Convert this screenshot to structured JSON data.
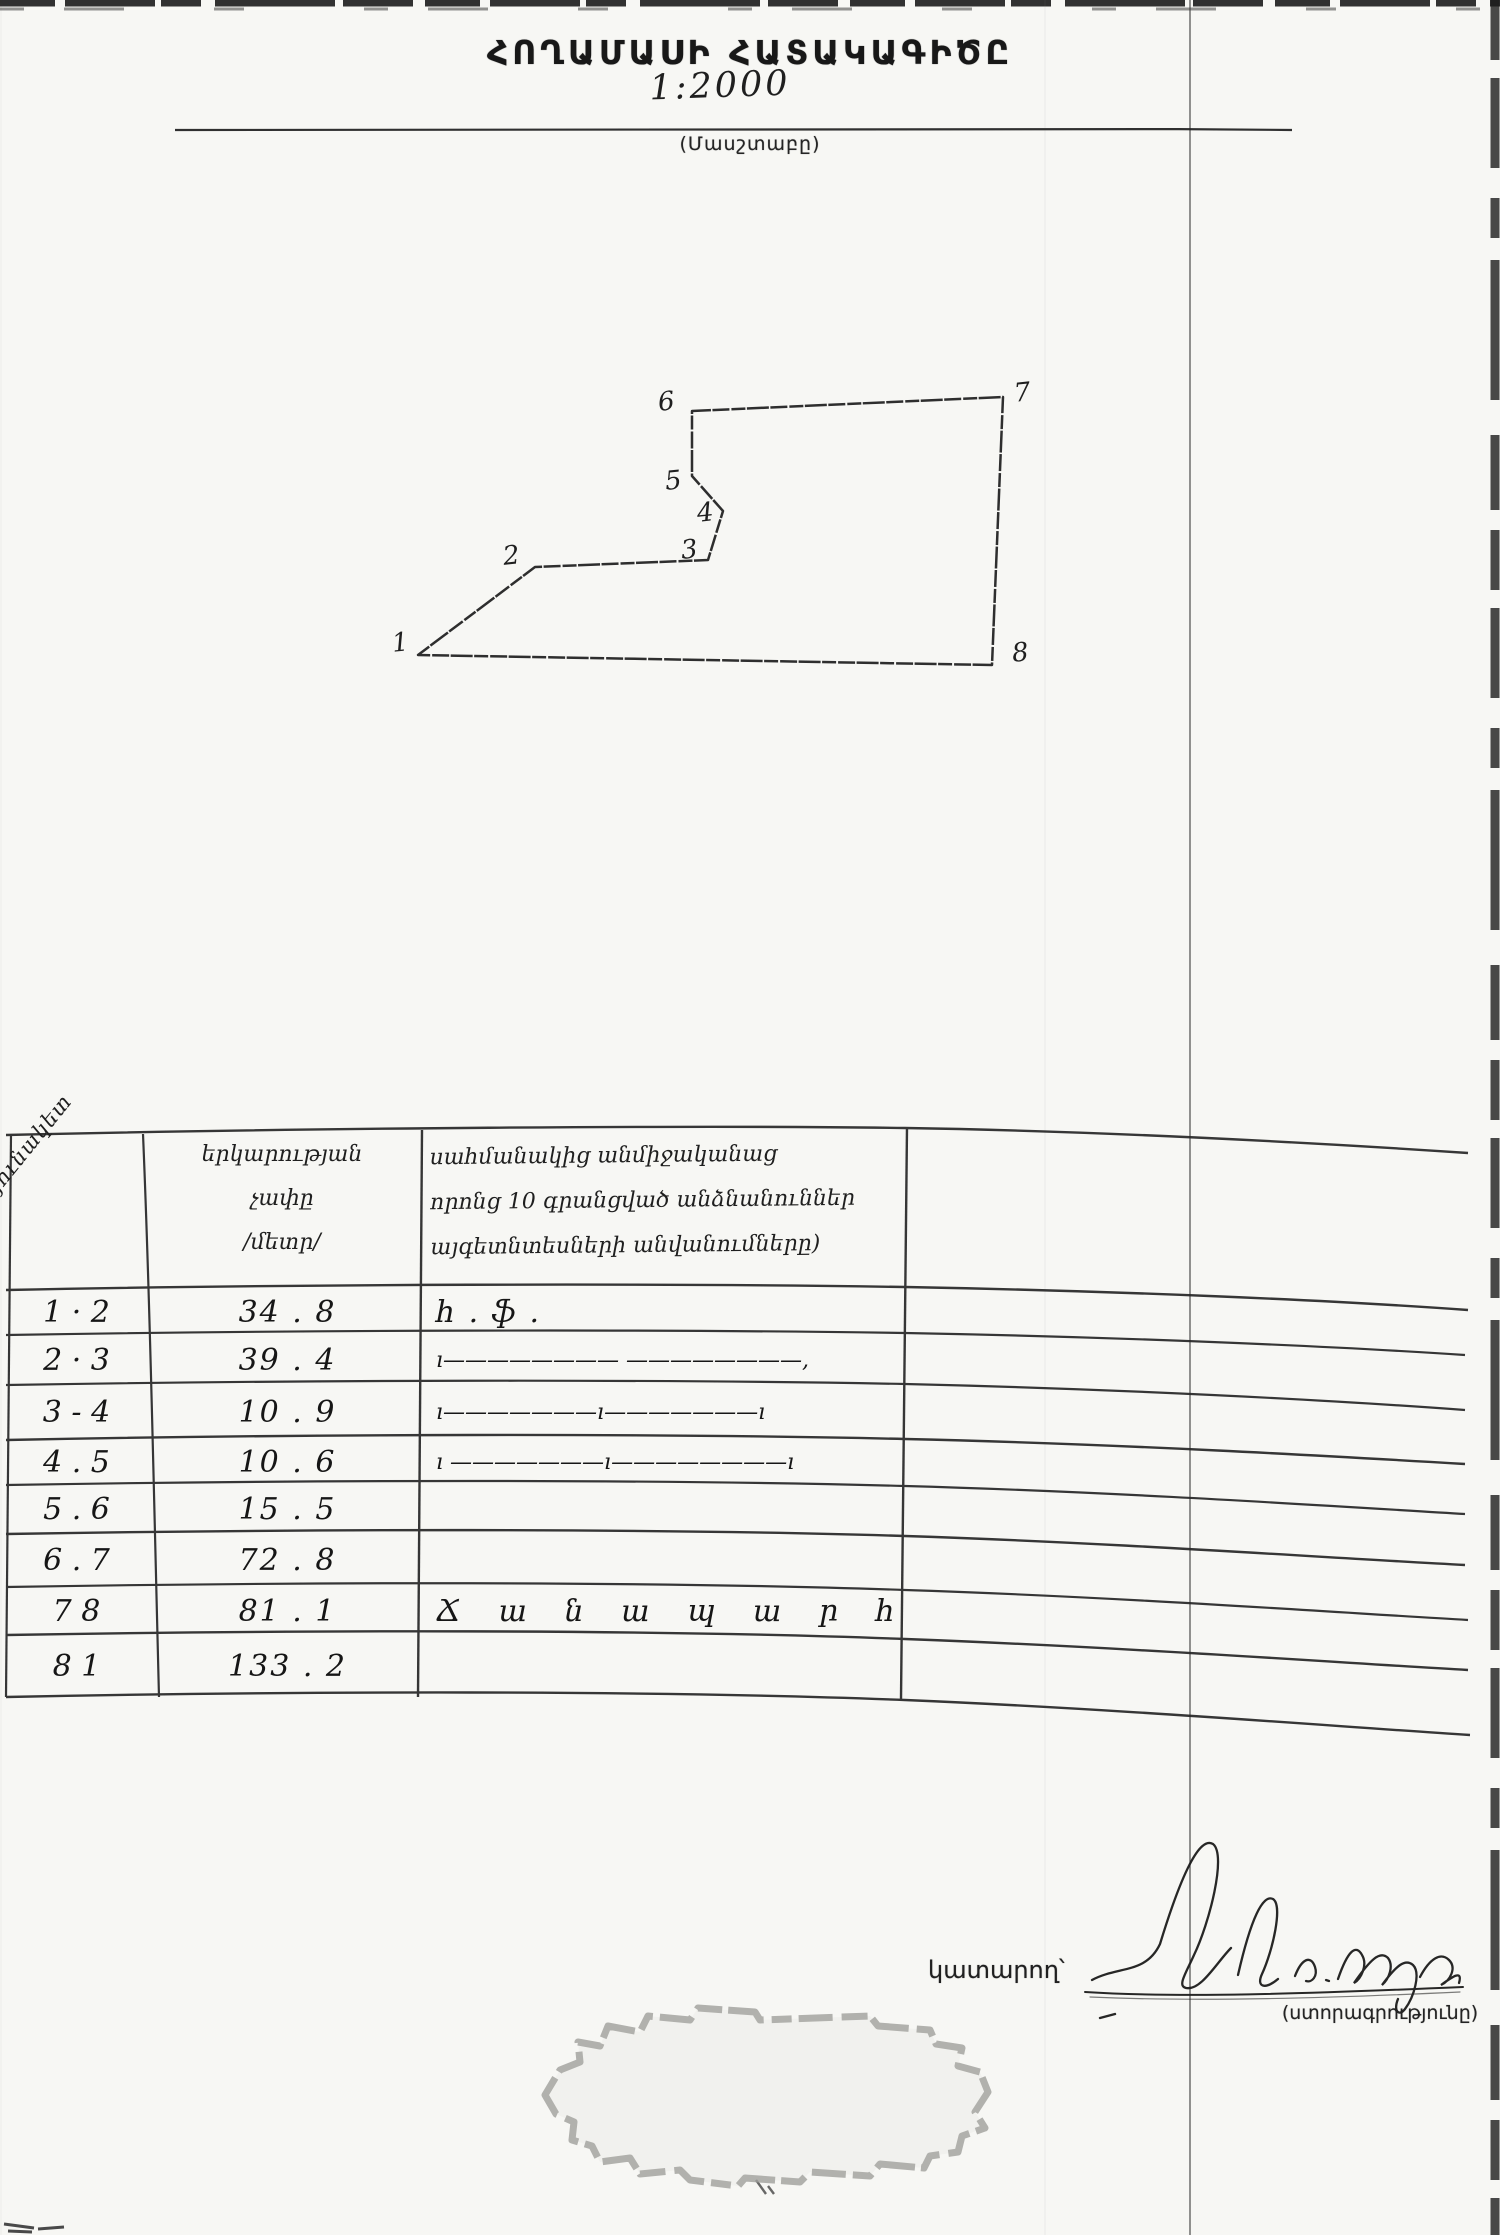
{
  "document": {
    "title": "ՀՈՂԱՄԱՍԻ ՀԱՏԱԿԱԳԻԾԸ",
    "scale": {
      "value": "1:2000",
      "caption": "(Մասշտաբը)"
    }
  },
  "plan": {
    "kind": "hand-drawn land plot boundary sketch with 8 numbered vertices",
    "vertex_labels": [
      "1",
      "2",
      "3",
      "4",
      "5",
      "6",
      "7",
      "8"
    ]
  },
  "table": {
    "header": {
      "col1_rotated": "անկյունակետ",
      "col2_lines": [
        "երկարության",
        "չափը",
        "/մետր/"
      ],
      "col3_lines": [
        "սահմանակից անմիջականաց",
        "որոնց 10 գրանցված անձնանուններ",
        "այգետնտեսների անվանումները)"
      ]
    },
    "rows": [
      {
        "segment": "1 · 2",
        "length": "34 . 8",
        "neighbor": "հ . ֆ ."
      },
      {
        "segment": "2 · 3",
        "length": "39 . 4",
        "neighbor": "ı———————— ————————,"
      },
      {
        "segment": "3 - 4",
        "length": "10 . 9",
        "neighbor": "ı———————ı———————ı"
      },
      {
        "segment": "4 . 5",
        "length": "10 . 6",
        "neighbor": "ı ———————ı————————ı"
      },
      {
        "segment": "5 . 6",
        "length": "15 . 5",
        "neighbor": ""
      },
      {
        "segment": "6 . 7",
        "length": "72 . 8",
        "neighbor": ""
      },
      {
        "segment": "7  8",
        "length": "81 . 1",
        "neighbor": "Ճ ա ն ա պ ա ր հ"
      },
      {
        "segment": "8  1",
        "length": "133 . 2",
        "neighbor": ""
      }
    ]
  },
  "footer": {
    "executor_label": "կատարող՝",
    "signature_caption": "(ստորագրությունը)",
    "signature_note": "անընթեռնելի ձեռագիր ստորագրություն"
  },
  "colors": {
    "ink": "#222222",
    "paper": "#f7f7f4",
    "stamp": "#a0a09c"
  }
}
